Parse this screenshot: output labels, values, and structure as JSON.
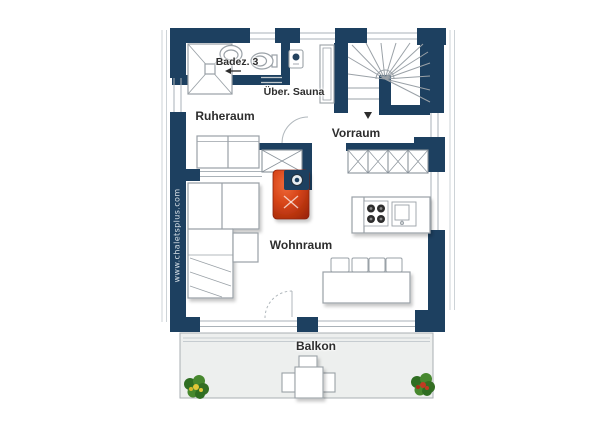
{
  "watermark": "www.chaletsplus.com",
  "rooms": {
    "bathroom": "Badez. 3",
    "sauna": "Über. Sauna",
    "rest_room": "Ruheraum",
    "anteroom": "Vorraum",
    "living_room": "Wohnraum",
    "balcony": "Balkon"
  },
  "colors": {
    "wall_navy": "#1d4060",
    "stove_red": "#cf3a15",
    "stove_highlight": "#f06a3a",
    "balcony_floor": "#edefee",
    "outline_gray": "#9aa1a7",
    "thin_line_gray": "#c6ccd0",
    "label_text": "#2d2d2d",
    "watermark_text": "#d8e0e7",
    "plant_green": "#47882e",
    "flower_yellow": "#e3c838",
    "flower_red": "#c03a22"
  },
  "fixtures": [
    "shower",
    "washbasin",
    "toilet",
    "sauna-heater",
    "sauna-bench",
    "winder-staircase",
    "wardrobe",
    "tiled-stove",
    "flue-ring",
    "kitchen-counter",
    "cooktop",
    "kitchen-sink",
    "sofa",
    "corner-sofa",
    "side-table",
    "dining-table",
    "dining-chairs",
    "balcony-table",
    "balcony-chairs",
    "flower-pot-left",
    "flower-pot-right",
    "door-arc",
    "direction-arrow"
  ]
}
